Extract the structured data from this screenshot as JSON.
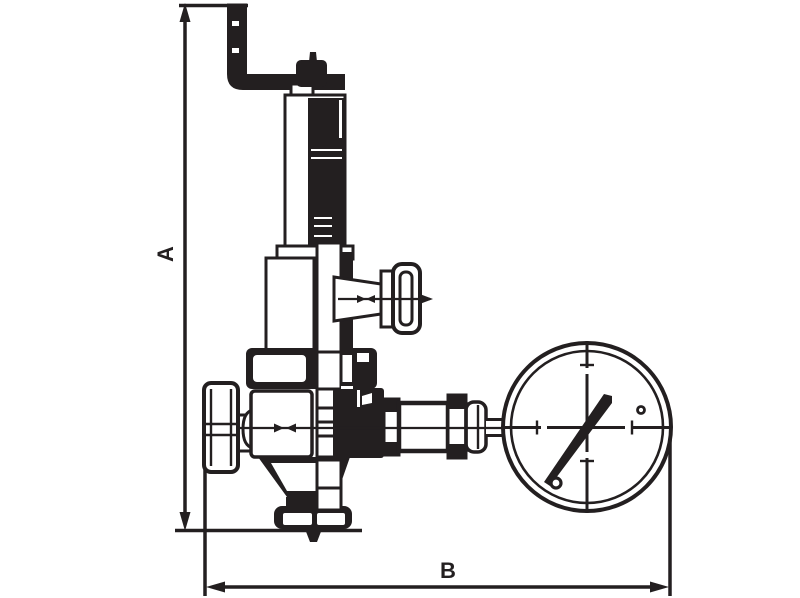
{
  "drawing": {
    "title": "pressure-reducing-valve-with-gauge-outline-drawing",
    "dimensions": {
      "vertical": {
        "label": "A"
      },
      "horizontal": {
        "label": "B"
      }
    },
    "colors": {
      "line": "#231f20",
      "background": "#ffffff"
    }
  }
}
